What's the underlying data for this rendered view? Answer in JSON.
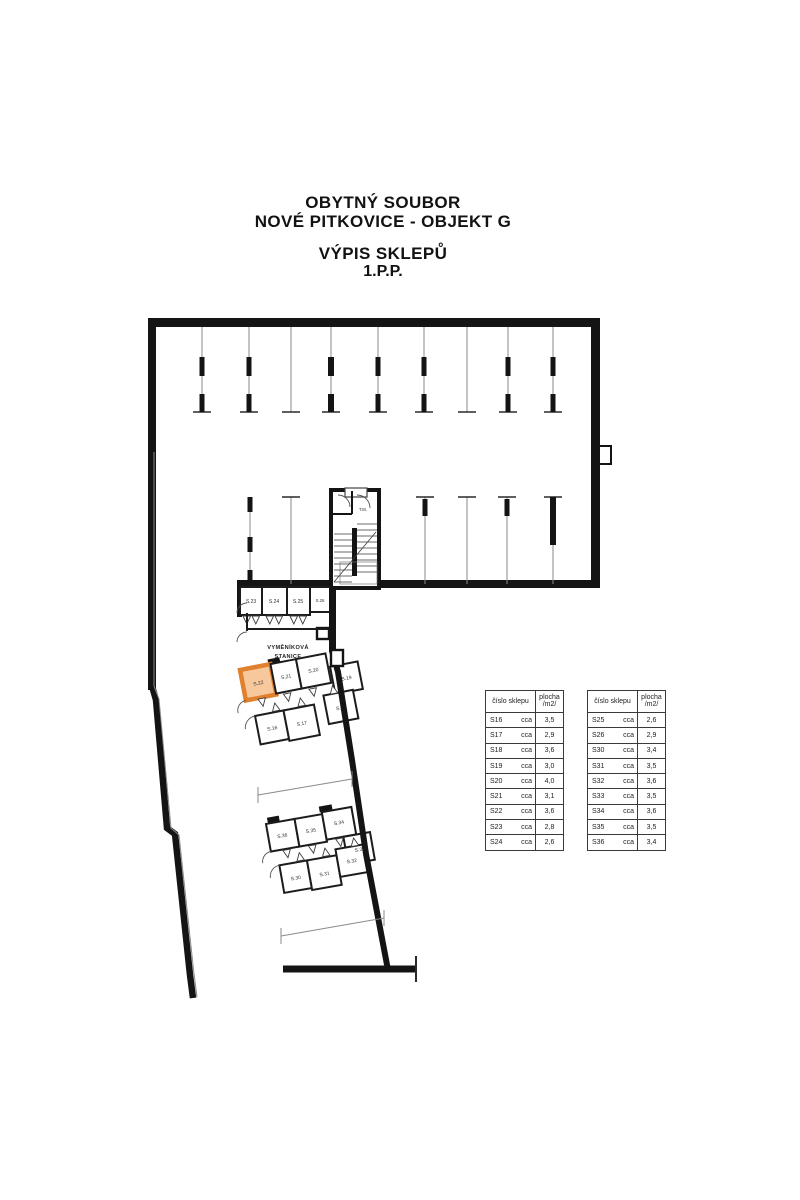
{
  "title": {
    "line1": "OBYTNÝ SOUBOR",
    "line2": "NOVÉ PITKOVICE - OBJEKT G",
    "line3": "VÝPIS SKLEPŮ",
    "line4": "1.P.P."
  },
  "plan": {
    "stairs_label": "T.M.",
    "station_label_line1": "VYMĚNÍKOVÁ",
    "station_label_line2": "STANICE",
    "highlighted_cellar": "S.22",
    "highlight_border_color": "#e0812f",
    "highlight_fill_color": "#f6c89c",
    "wall_color": "#141414",
    "cells": {
      "s16": "S.16",
      "s17": "S.17",
      "s18": "S.18",
      "s19": "S.19",
      "s20": "S.20",
      "s21": "S.21",
      "s22": "S.22",
      "s23": "S.23",
      "s24": "S.24",
      "s25": "S.25",
      "s26": "S.26",
      "s30": "S.30",
      "s31": "S.31",
      "s32": "S.32",
      "s33": "S.33",
      "s34": "S.34",
      "s35": "S.35",
      "s36": "S.36"
    }
  },
  "tables": {
    "header_col1": "číslo sklepu",
    "header_col2_line1": "plocha",
    "header_col2_line2": "/m2/",
    "table1": {
      "rows": [
        [
          "S16",
          "cca",
          "3,5"
        ],
        [
          "S17",
          "cca",
          "2,9"
        ],
        [
          "S18",
          "cca",
          "3,6"
        ],
        [
          "S19",
          "cca",
          "3,0"
        ],
        [
          "S20",
          "cca",
          "4,0"
        ],
        [
          "S21",
          "cca",
          "3,1"
        ],
        [
          "S22",
          "cca",
          "3,6"
        ],
        [
          "S23",
          "cca",
          "2,8"
        ],
        [
          "S24",
          "cca",
          "2,6"
        ]
      ]
    },
    "table2": {
      "rows": [
        [
          "S25",
          "cca",
          "2,6"
        ],
        [
          "S26",
          "cca",
          "2,9"
        ],
        [
          "S30",
          "cca",
          "3,4"
        ],
        [
          "S31",
          "cca",
          "3,5"
        ],
        [
          "S32",
          "cca",
          "3,6"
        ],
        [
          "S33",
          "cca",
          "3,5"
        ],
        [
          "S34",
          "cca",
          "3,6"
        ],
        [
          "S35",
          "cca",
          "3,5"
        ],
        [
          "S36",
          "cca",
          "3,4"
        ]
      ]
    }
  }
}
